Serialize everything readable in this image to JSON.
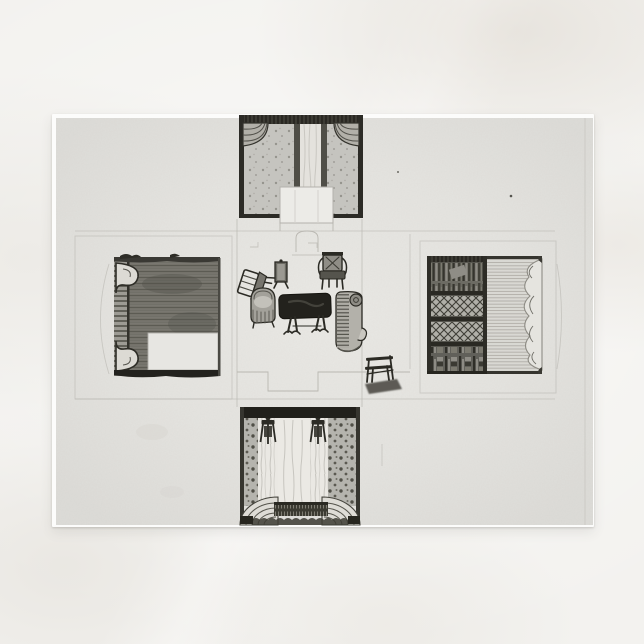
{
  "colors": {
    "page_background": "#f3f2ef",
    "postcard_paper": "#fcfcfb",
    "print_paper": "#e3e2df",
    "drawing_ink": "#2b2a24",
    "pencil_line": "#aeaca5",
    "wash_mid": "#8b8a83",
    "highlight_paper": "#ecebe7"
  },
  "scene": {
    "subject": "postcard-product-photo",
    "background": "pale-marble-surface",
    "artwork": {
      "style": "monochrome-ink-and-wash-design-drawing",
      "layout": "cross-shaped-unfolded-room: central floor plan with four fold-out wall elevations",
      "panels": [
        {
          "id": "top-wall",
          "features": [
            "fringed-cornice",
            "corner-swag-curtains",
            "sprigged-wallpaper",
            "central-light-curtain",
            "chimney-breast-flap"
          ]
        },
        {
          "id": "left-wall",
          "features": [
            "dark-washed-panelling",
            "laddered-pilaster-strip",
            "scroll-ornaments",
            "blank-door-cutout"
          ]
        },
        {
          "id": "right-wall",
          "features": [
            "bookcase-with-lattice-doors",
            "book-shelves",
            "striped-curtain",
            "scalloped-drapery-edge"
          ]
        },
        {
          "id": "bottom-wall",
          "features": [
            "dark-cornice-band",
            "spotted-wallpaper",
            "two-draped-bed-columns",
            "central-white-drape",
            "scalloped-fringed-valance"
          ]
        }
      ],
      "furniture": [
        "overturned-chair",
        "fire-screen",
        "open-armchair",
        "tub-chair",
        "dark-topped-centre-table",
        "chaise-longue",
        "x-frame-stool"
      ],
      "construction_marks": [
        "fold-lines",
        "flap-outlines",
        "stepped-floor-notches",
        "fireplace-arch"
      ]
    }
  }
}
